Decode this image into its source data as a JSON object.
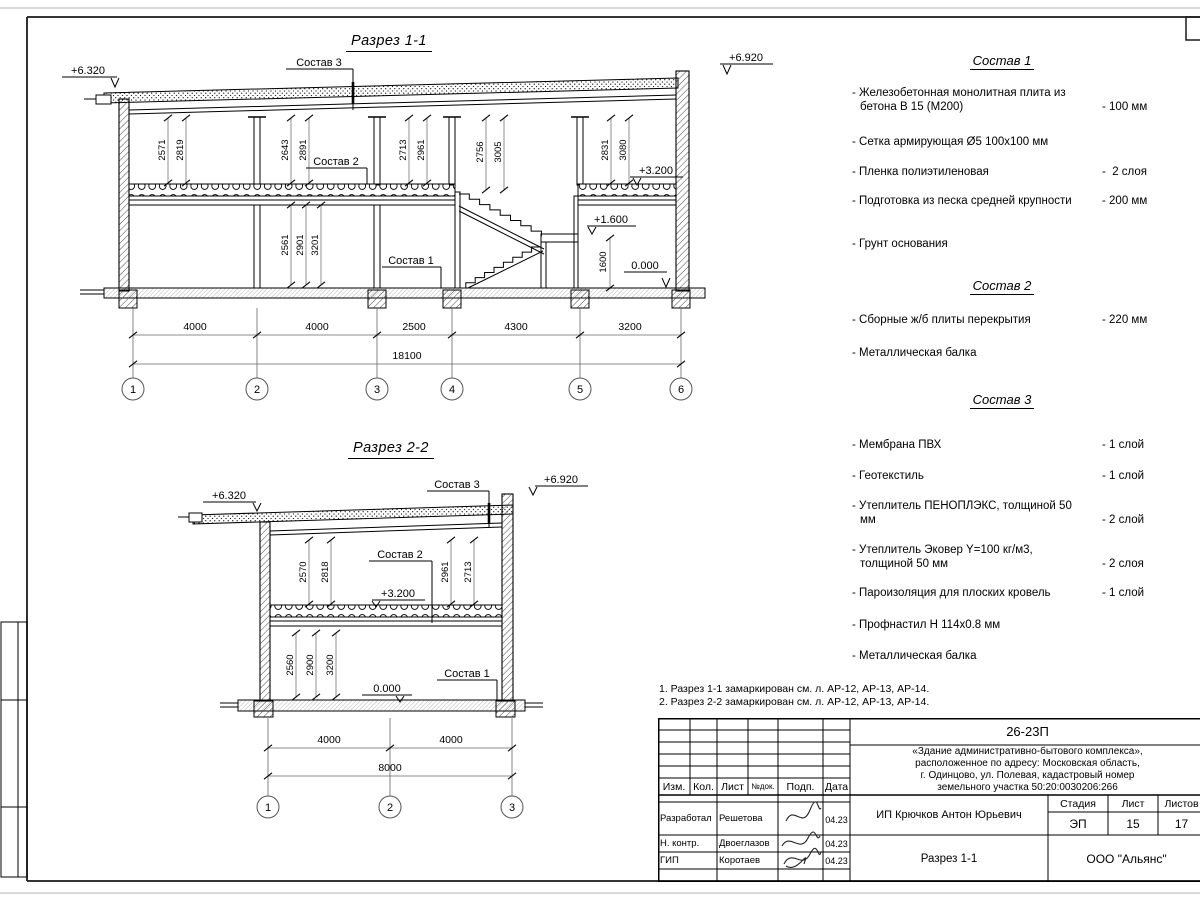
{
  "s11": {
    "title": "Разрез 1-1",
    "elev_left": "+6.320",
    "elev_right": "+6.920",
    "lvl_320": "+3.200",
    "lvl_160": "+1.600",
    "lvl_000": "0.000",
    "lbl_s3": "Состав 3",
    "lbl_s2": "Состав 2",
    "lbl_s1": "Состав 1",
    "vdims": [
      "2571",
      "2819",
      "2643",
      "2891",
      "2713",
      "2961",
      "2756",
      "3005",
      "2831",
      "3080"
    ],
    "vdims_lower": [
      "2561",
      "2901",
      "3201"
    ],
    "dim_1600": "1600",
    "bdims": [
      "4000",
      "4000",
      "2500",
      "4300",
      "3200"
    ],
    "total": "18100",
    "grids": [
      "1",
      "2",
      "3",
      "4",
      "5",
      "6"
    ]
  },
  "s22": {
    "title": "Разрез 2-2",
    "elev_left": "+6.320",
    "elev_right": "+6.920",
    "lvl_320": "+3.200",
    "lvl_000": "0.000",
    "lbl_s3": "Состав 3",
    "lbl_s2": "Состав 2",
    "lbl_s1": "Состав 1",
    "vdims": [
      "2570",
      "2818",
      "2961",
      "2713"
    ],
    "vdims_lower": [
      "2560",
      "2900",
      "3200"
    ],
    "bdims": [
      "4000",
      "4000"
    ],
    "total": "8000",
    "grids": [
      "1",
      "2",
      "3"
    ]
  },
  "sostav1": {
    "title": "Состав 1",
    "items": [
      {
        "name": "- Железобетонная  монолитная плита из бетона В 15 (М200)",
        "value": "- 100 мм"
      },
      {
        "name": "- Сетка армирующая Ø5 100х100 мм",
        "value": ""
      },
      {
        "name": "- Пленка полиэтиленовая",
        "value": "-  2 слоя"
      },
      {
        "name": "- Подготовка из песка средней крупности",
        "value": "- 200 мм"
      },
      {
        "name": "- Грунт основания",
        "value": ""
      }
    ]
  },
  "sostav2": {
    "title": "Состав 2",
    "items": [
      {
        "name": "- Сборные ж/б плиты перекрытия",
        "value": "- 220 мм"
      },
      {
        "name": "- Металлическая балка",
        "value": ""
      }
    ]
  },
  "sostav3": {
    "title": "Состав 3",
    "items": [
      {
        "name": "- Мембрана ПВХ",
        "value": "- 1 слой"
      },
      {
        "name": "- Геотекстиль",
        "value": "- 1 слой"
      },
      {
        "name": "- Утеплитель ПЕНОПЛЭКС, толщиной 50 мм",
        "value": "- 2 слой"
      },
      {
        "name": "- Утеплитель Эковер Y=100 кг/м3, толщиной 50 мм",
        "value": "- 2 слоя"
      },
      {
        "name": "- Пароизоляция для плоских кровель",
        "value": "- 1 слой"
      },
      {
        "name": "- Профнастил Н 114х0.8 мм",
        "value": ""
      },
      {
        "name": "- Металлическая балка",
        "value": ""
      }
    ]
  },
  "notes": [
    "1. Разрез 1-1 замаркирован см. л. АР-12, АР-13, АР-14.",
    "2. Разрез 2-2 замаркирован см. л. АР-12, АР-13, АР-14."
  ],
  "titleblock": {
    "doc_number": "26-23П",
    "project_lines": [
      "«Здание административно-бытового комплекса»,",
      "расположенное по адресу: Московская область,",
      "г. Одинцово, ул. Полевая, кадастровый номер",
      "земельного участка 50:20:0030206:266"
    ],
    "col_izm": "Изм.",
    "col_kol": "Кол.",
    "col_list": "Лист",
    "col_ndok": "№док.",
    "col_podp": "Подп.",
    "col_data": "Дата",
    "row1_role": "Разработал",
    "row1_name": "Решетова",
    "row1_date": "04.23",
    "row2_role": "Н. контр.",
    "row2_name": "Двоеглазов",
    "row2_date": "04.23",
    "row3_role": "ГИП",
    "row3_name": "Коротаев",
    "row3_date": "04.23",
    "customer": "ИП Крючков Антон Юрьевич",
    "stage_label": "Стадия",
    "sheet_label": "Лист",
    "sheets_label": "Листов",
    "stage": "ЭП",
    "sheet": "15",
    "sheets": "17",
    "drawing_name": "Разрез 1-1",
    "company": "ООО \"Альянс\""
  }
}
